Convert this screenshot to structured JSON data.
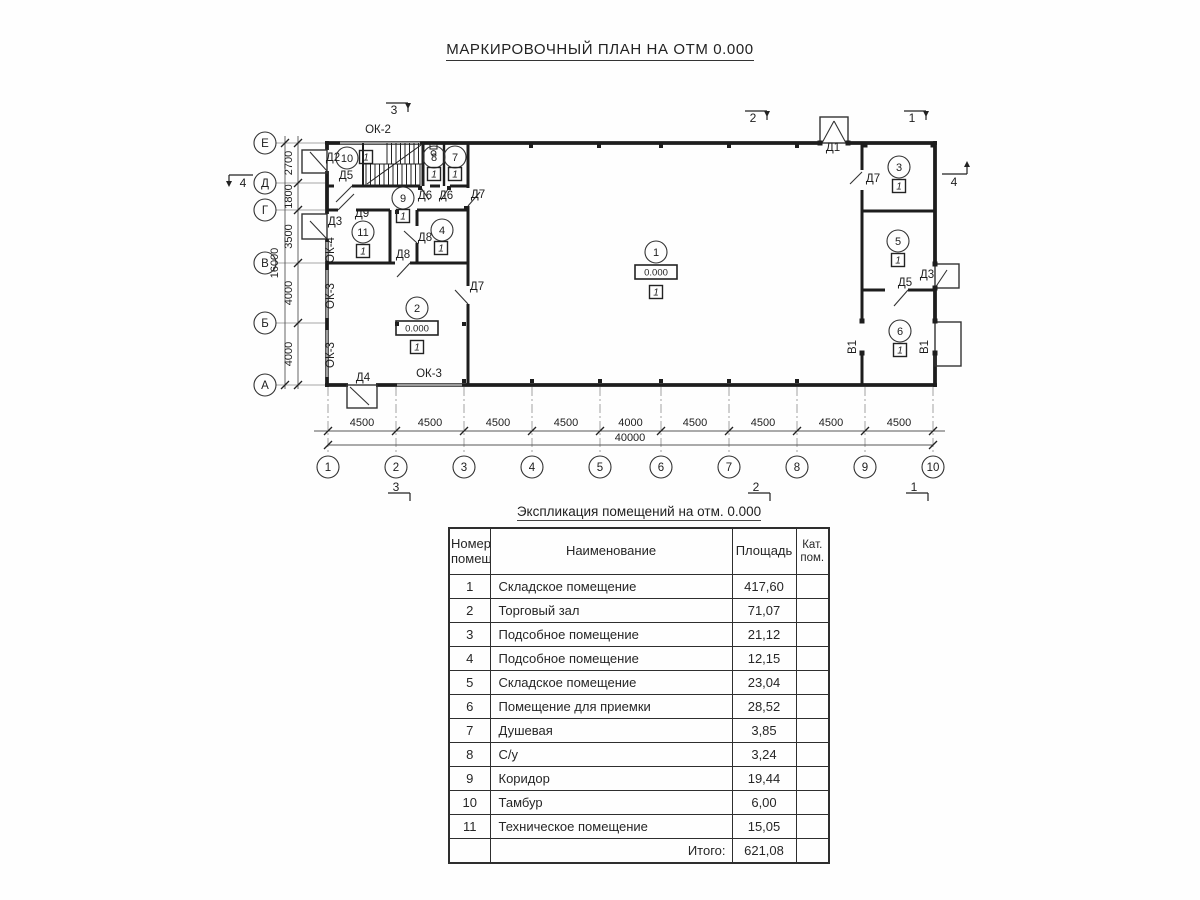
{
  "plan": {
    "title": "МАРКИРОВОЧНЫЙ ПЛАН НА ОТМ 0.000",
    "grid": {
      "cols": [
        {
          "label": "1",
          "x": 328
        },
        {
          "label": "2",
          "x": 396
        },
        {
          "label": "3",
          "x": 464
        },
        {
          "label": "4",
          "x": 532
        },
        {
          "label": "5",
          "x": 600
        },
        {
          "label": "6",
          "x": 661
        },
        {
          "label": "7",
          "x": 729
        },
        {
          "label": "8",
          "x": 797
        },
        {
          "label": "9",
          "x": 865
        },
        {
          "label": "10",
          "x": 933
        }
      ],
      "col_dims": [
        "4500",
        "4500",
        "4500",
        "4500",
        "4000",
        "4500",
        "4500",
        "4500",
        "4500"
      ],
      "total_width": "40000",
      "rows": [
        {
          "label": "Е",
          "y": 143
        },
        {
          "label": "Д",
          "y": 183
        },
        {
          "label": "Г",
          "y": 210
        },
        {
          "label": "В",
          "y": 263
        },
        {
          "label": "Б",
          "y": 323
        },
        {
          "label": "А",
          "y": 385
        }
      ],
      "row_dims": [
        "2700",
        "1800",
        "3500",
        "4000",
        "4000"
      ],
      "total_height": "16000"
    },
    "rooms": [
      {
        "num": "1",
        "cx": 656,
        "cy": 252,
        "sq": [
          656,
          292
        ],
        "marker": "1",
        "elev": "0.000",
        "ebox": [
          656,
          272
        ]
      },
      {
        "num": "2",
        "cx": 417,
        "cy": 308,
        "sq": [
          417,
          347
        ],
        "marker": "1",
        "elev": "0.000",
        "ebox": [
          417,
          328
        ]
      },
      {
        "num": "3",
        "cx": 899,
        "cy": 167,
        "sq": [
          899,
          186
        ],
        "marker": "1"
      },
      {
        "num": "4",
        "cx": 442,
        "cy": 230,
        "sq": [
          441,
          248
        ],
        "marker": "1"
      },
      {
        "num": "5",
        "cx": 898,
        "cy": 241,
        "sq": [
          898,
          260
        ],
        "marker": "1"
      },
      {
        "num": "6",
        "cx": 900,
        "cy": 331,
        "sq": [
          900,
          350
        ],
        "marker": "1"
      },
      {
        "num": "7",
        "cx": 455,
        "cy": 157,
        "sq": [
          455,
          174
        ],
        "marker": "1"
      },
      {
        "num": "8",
        "cx": 434,
        "cy": 157,
        "sq": [
          434,
          174
        ],
        "marker": "1"
      },
      {
        "num": "9",
        "cx": 403,
        "cy": 198,
        "sq": [
          403,
          216
        ],
        "marker": "1"
      },
      {
        "num": "10",
        "cx": 347,
        "cy": 158,
        "sq": [
          366,
          157
        ],
        "marker": "1"
      },
      {
        "num": "11",
        "cx": 363,
        "cy": 232,
        "sq": [
          363,
          251
        ],
        "marker": "1"
      }
    ],
    "door_labels": [
      {
        "text": "Д2",
        "x": 333,
        "y": 161
      },
      {
        "text": "Д5",
        "x": 346,
        "y": 179
      },
      {
        "text": "Д9",
        "x": 362,
        "y": 217
      },
      {
        "text": "Д3",
        "x": 335,
        "y": 225
      },
      {
        "text": "Д8",
        "x": 425,
        "y": 241
      },
      {
        "text": "Д8",
        "x": 403,
        "y": 258
      },
      {
        "text": "Д7",
        "x": 478,
        "y": 198
      },
      {
        "text": "Д7",
        "x": 477,
        "y": 290
      },
      {
        "text": "Д6",
        "x": 425,
        "y": 199
      },
      {
        "text": "Д6",
        "x": 446,
        "y": 199
      },
      {
        "text": "Д4",
        "x": 363,
        "y": 381
      },
      {
        "text": "Д1",
        "x": 833,
        "y": 151
      },
      {
        "text": "Д7",
        "x": 873,
        "y": 182
      },
      {
        "text": "Д5",
        "x": 905,
        "y": 286
      },
      {
        "text": "Д3",
        "x": 927,
        "y": 278
      }
    ],
    "window_labels": [
      {
        "text": "ОК-2",
        "x": 378,
        "y": 133,
        "rot": 0
      },
      {
        "text": "ОК-4",
        "x": 334,
        "y": 250,
        "rot": -90
      },
      {
        "text": "ОК-3",
        "x": 334,
        "y": 296,
        "rot": -90
      },
      {
        "text": "ОК-3",
        "x": 334,
        "y": 355,
        "rot": -90
      },
      {
        "text": "ОК-3",
        "x": 429,
        "y": 377,
        "rot": 0
      }
    ],
    "gate_labels": [
      {
        "text": "В1",
        "x": 856,
        "y": 347
      },
      {
        "text": "В1",
        "x": 928,
        "y": 347
      }
    ],
    "section_marks": [
      {
        "label": "3",
        "x": 394,
        "y": 111,
        "type": "td"
      },
      {
        "label": "2",
        "x": 753,
        "y": 119,
        "type": "td"
      },
      {
        "label": "1",
        "x": 912,
        "y": 119,
        "type": "td"
      },
      {
        "label": "4",
        "x": 243,
        "y": 184,
        "type": "ld"
      },
      {
        "label": "4",
        "x": 954,
        "y": 183,
        "type": "ru"
      },
      {
        "label": "3",
        "x": 396,
        "y": 488,
        "type": "bd"
      },
      {
        "label": "2",
        "x": 756,
        "y": 488,
        "type": "bd"
      },
      {
        "label": "1",
        "x": 914,
        "y": 488,
        "type": "bd"
      }
    ]
  },
  "schedule": {
    "title": "Экспликация помещений на отм. 0.000",
    "headers": [
      [
        "Номер",
        "помещ."
      ],
      [
        "Наименование"
      ],
      [
        "Площадь"
      ],
      [
        "Кат.",
        "пом."
      ]
    ],
    "rows": [
      [
        "1",
        "Складское помещение",
        "417,60",
        ""
      ],
      [
        "2",
        "Торговый зал",
        "71,07",
        ""
      ],
      [
        "3",
        "Подсобное помещение",
        "21,12",
        ""
      ],
      [
        "4",
        "Подсобное помещение",
        "12,15",
        ""
      ],
      [
        "5",
        "Складское помещение",
        "23,04",
        ""
      ],
      [
        "6",
        "Помещение для приемки",
        "28,52",
        ""
      ],
      [
        "7",
        "Душевая",
        "3,85",
        ""
      ],
      [
        "8",
        "С/у",
        "3,24",
        ""
      ],
      [
        "9",
        "Коридор",
        "19,44",
        ""
      ],
      [
        "10",
        "Тамбур",
        "6,00",
        ""
      ],
      [
        "11",
        "Техническое помещение",
        "15,05",
        ""
      ]
    ],
    "total": {
      "label": "Итого:",
      "value": "621,08"
    }
  },
  "colors": {
    "line": "#1d1d1d",
    "thin": "#333333",
    "window": "#9b9b9b",
    "dim": "#555555",
    "text": "#1e1e1e",
    "axis": "#8a8a8a"
  }
}
